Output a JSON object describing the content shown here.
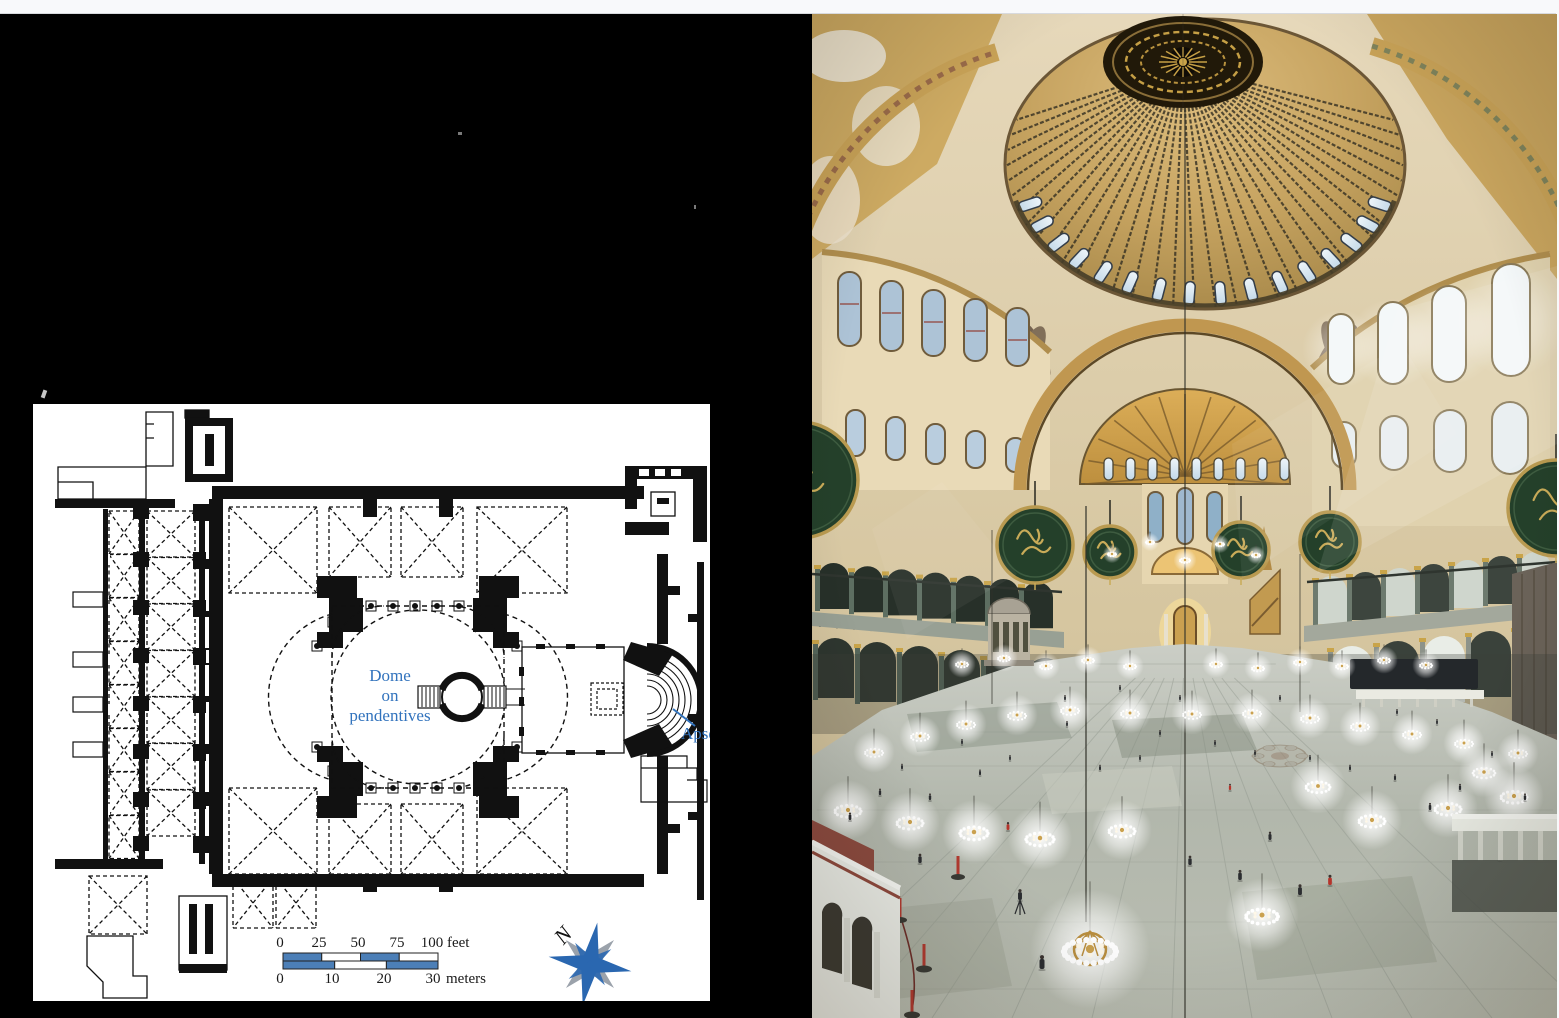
{
  "floor_plan": {
    "dome_label": {
      "line1": "Dome",
      "line2": "on",
      "line3": "pendentives"
    },
    "apse_label": "Apse",
    "scale": {
      "feet_ticks": [
        "0",
        "25",
        "50",
        "75",
        "100"
      ],
      "feet_unit": "feet",
      "meters_ticks": [
        "0",
        "10",
        "20",
        "30"
      ],
      "meters_unit": "meters"
    },
    "compass": {
      "north": "N"
    },
    "colors": {
      "label_blue": "#3273bd",
      "scale_blue": "#4c7fb7",
      "compass_blue": "#2a67b0",
      "compass_gray": "#9ba2ab"
    }
  }
}
